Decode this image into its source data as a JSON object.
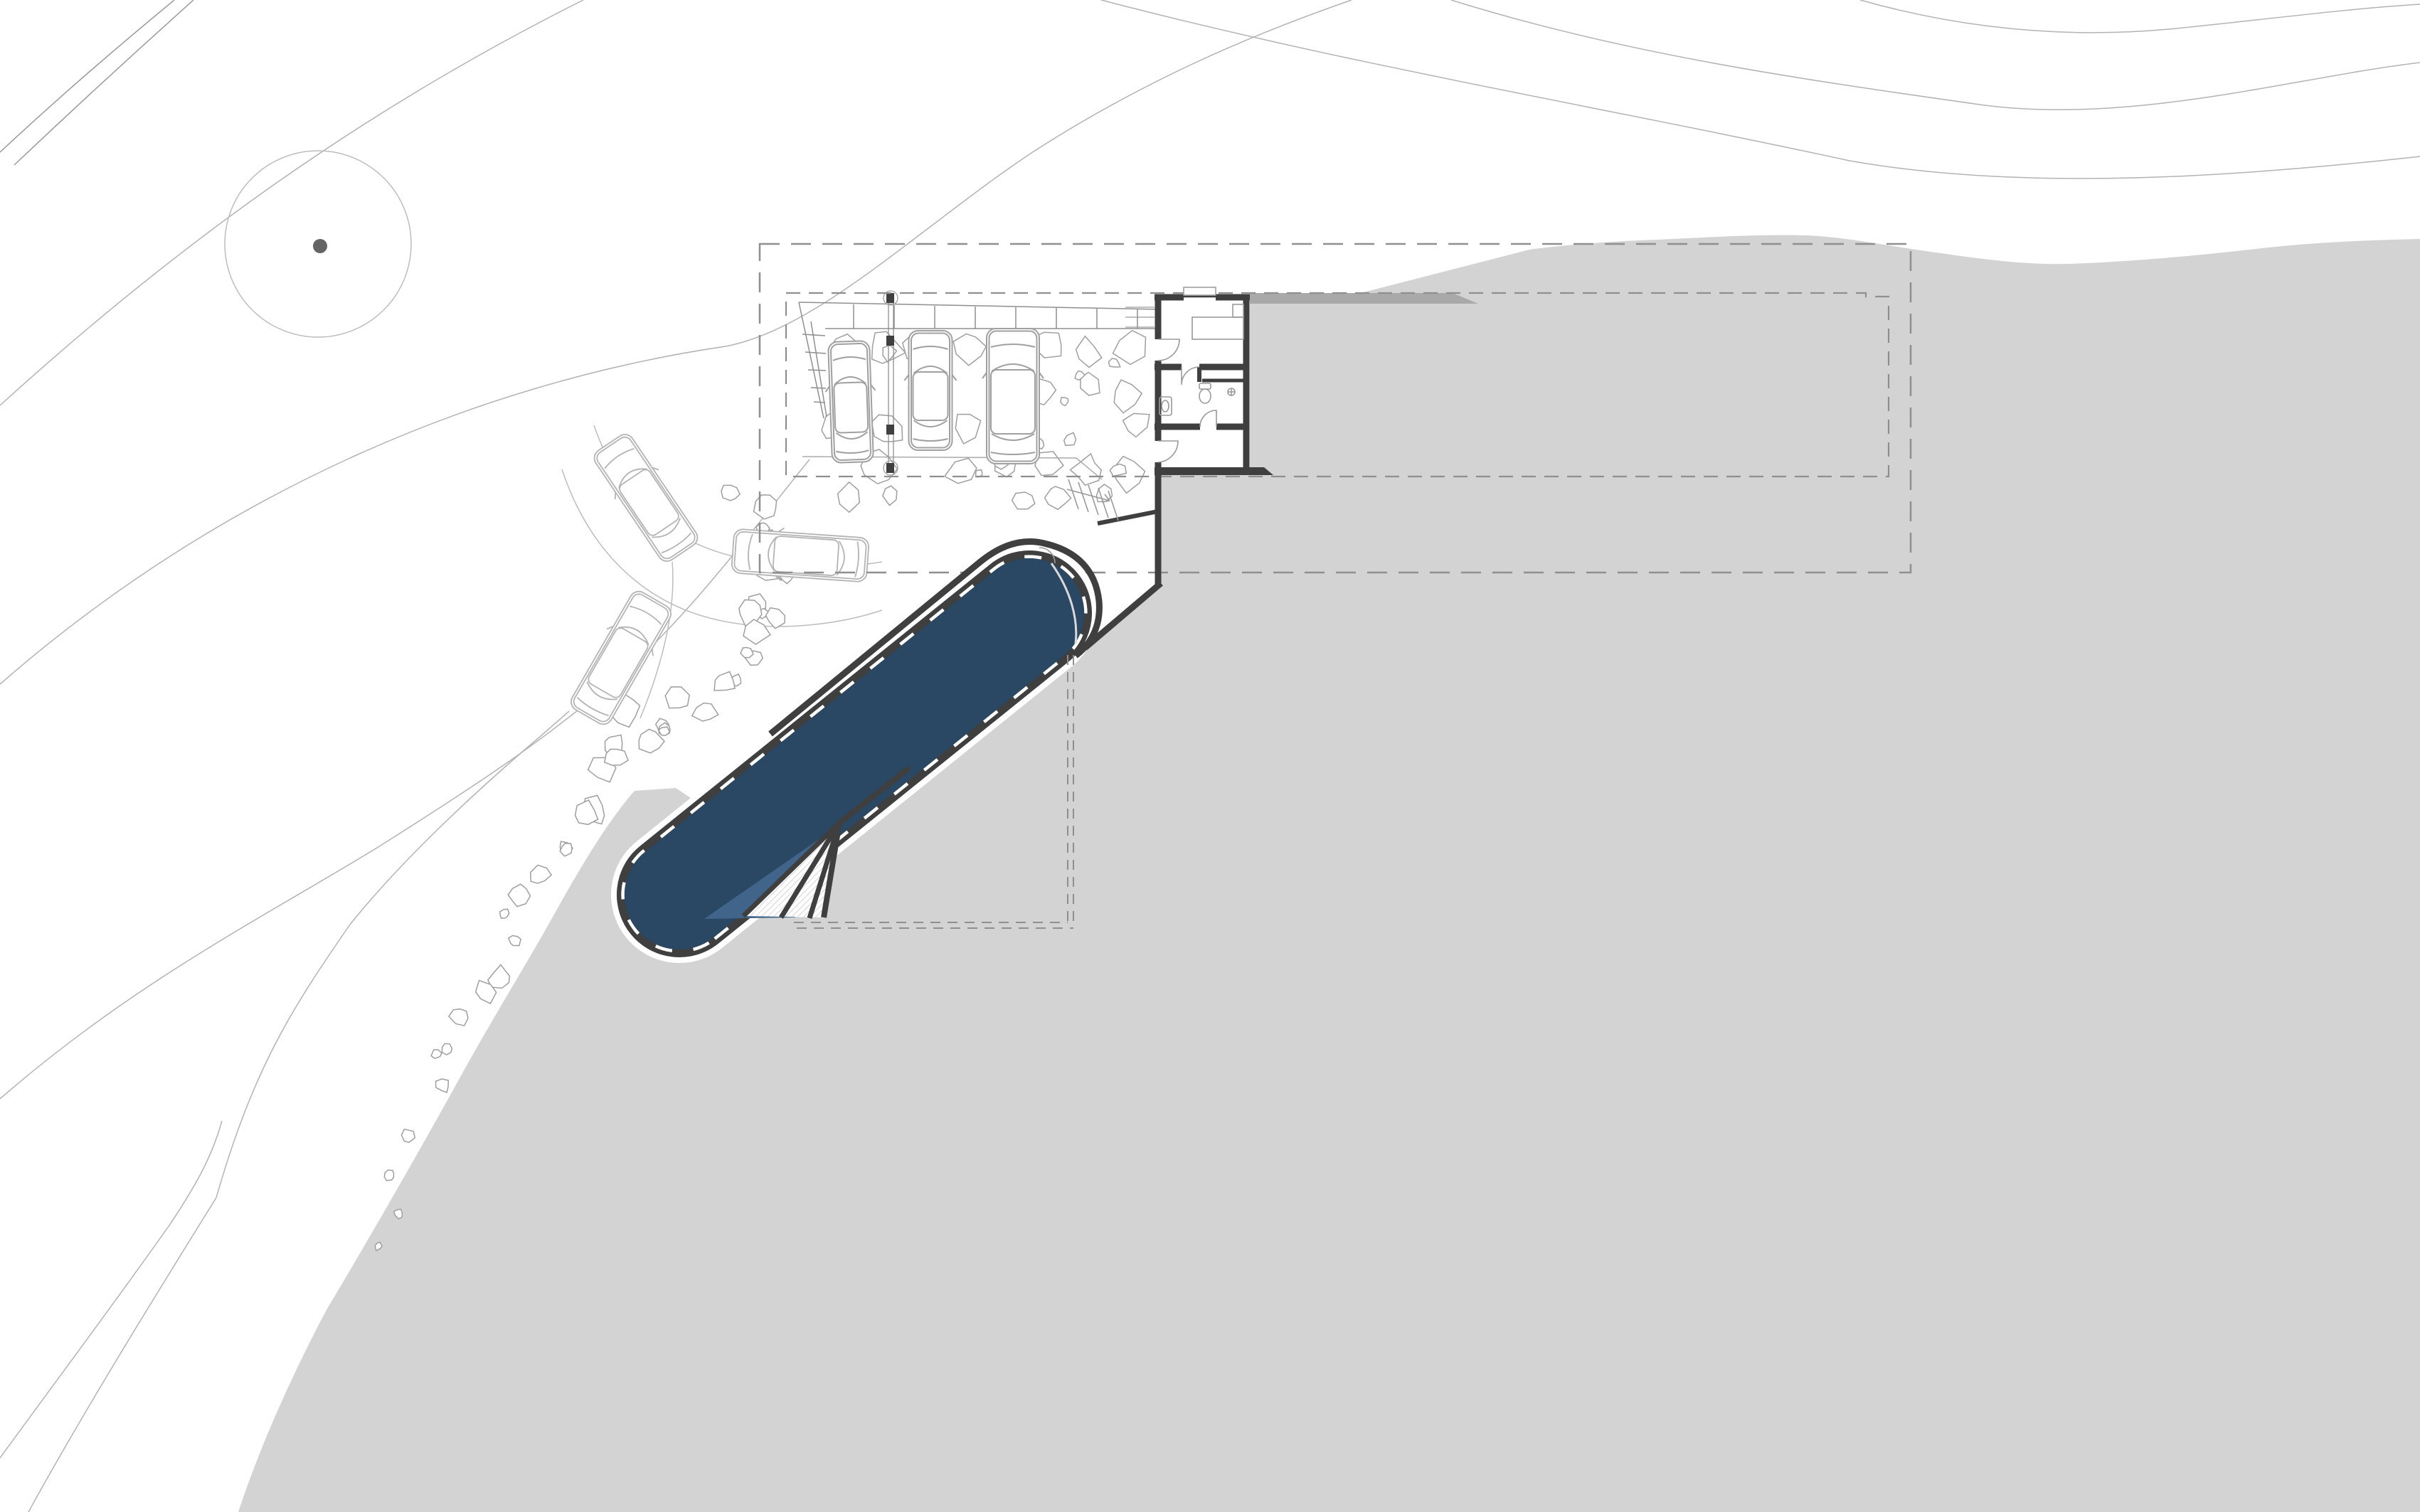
{
  "meta": {
    "kind": "architectural-site-plan",
    "level": "pool-terrace-level",
    "visible_text": []
  },
  "colors": {
    "paper": "#ffffff",
    "terrain": "#d3d3d3",
    "roof_edge_band": "#a9a9a9",
    "wall": "#3f3f3f",
    "pool_water": "#2a4763",
    "pool_shallow": "#41648a",
    "pool_joint_dash": "#ffffff",
    "contour": "#b3b3b3",
    "contour_dark": "#9a9a9a",
    "dashed_outline": "#8f8f8f",
    "stone_outline": "#9f9f9f",
    "car_outline": "#a0a0a0",
    "ghost_car_outline": "#b4b4b4",
    "fixture_outline": "#9a9a9a",
    "tree_outline": "#bdbdbd",
    "tree_trunk": "#646464",
    "drive_edge": "#bdbdbd",
    "step_hatch": "#c9c9c9",
    "handrail": "#d8d8d8",
    "terrace_line": "#ababab"
  },
  "elements": {
    "tree_count": 1,
    "parked_car_count": 3,
    "turning_template_car_count": 3,
    "pool_count": 1,
    "pool_step_count": 3,
    "dashed_roof_outlines": 2,
    "building_rooms": [
      "studio",
      "bathroom",
      "shower",
      "entry room"
    ],
    "stairs": [
      "entry stair",
      "pool landing"
    ]
  }
}
